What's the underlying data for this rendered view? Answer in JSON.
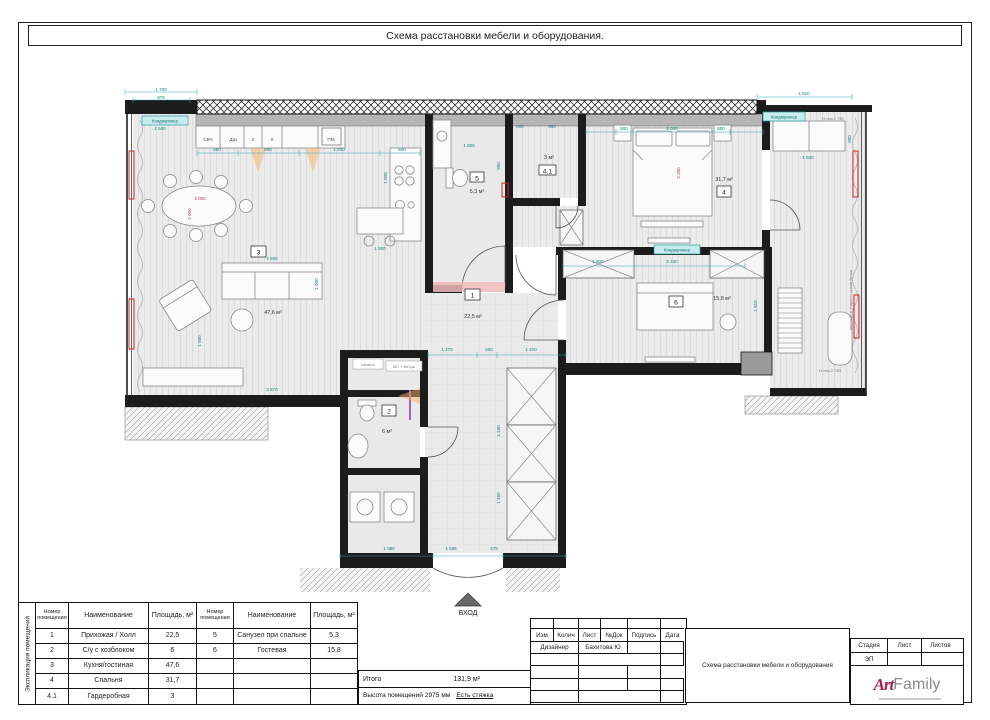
{
  "sheet": {
    "title": "Схема расстановки мебели и оборудования.",
    "side_label": "Экспликация помещений"
  },
  "plan": {
    "entrance_label": "ВХОД",
    "ac_label": "Кондиционер",
    "rooms": {
      "r1": {
        "num": "1",
        "area": "22,5 м²"
      },
      "r2": {
        "num": "2",
        "area": "6 м²"
      },
      "r3": {
        "num": "3",
        "area": "47,6 м²"
      },
      "r4": {
        "num": "4",
        "area": "31,7 м²"
      },
      "r41": {
        "num": "4.1",
        "area": "3 м²"
      },
      "r5": {
        "num": "5",
        "area": "5,3 м²"
      },
      "r6": {
        "num": "6",
        "area": "15,8 м²"
      }
    },
    "appliances": {
      "svch": "СВЧ",
      "dsh": "ДШ",
      "x1": "Х",
      "x2": "Х",
      "pm": "ПМ",
      "ms": "МС + МСуш",
      "shtanga": "Штанга"
    },
    "notes": {
      "laundry": "место для стирки и сушки белья",
      "h1": "H низ 2 730",
      "h2": "H низ 2 730"
    },
    "dims": {
      "d1": "1 700",
      "d2": "970",
      "d3": "600",
      "d4": "900",
      "d5": "1 200",
      "d6": "600",
      "d7": "500",
      "d8": "2 000",
      "d9": "500",
      "d10": "1 820",
      "d11": "1 600",
      "d12": "800",
      "d13": "2 300",
      "d14": "2 600",
      "d15": "1 000",
      "d16": "2 000",
      "d17": "1 000",
      "d18": "1 500",
      "d19": "1 500",
      "d20": "2 870",
      "d21": "1 500",
      "d22": "1 500",
      "d23": "1 600",
      "d24": "900",
      "d25": "600",
      "d26": "980",
      "d27": "1 800",
      "d28": "2 100",
      "d29": "1 810",
      "d30": "1 470",
      "d31": "600",
      "d32": "1 400",
      "d33": "1 160",
      "d34": "1 450",
      "d35": "1 085",
      "d36": "1 595",
      "d37": "475"
    }
  },
  "explication": {
    "headers": {
      "num": "Номер помещения",
      "name": "Наименование",
      "area": "Площадь, м²"
    },
    "left_rows": [
      [
        "1",
        "Прихожая / Холл",
        "22,5"
      ],
      [
        "2",
        "С/у с хозблоком",
        "6"
      ],
      [
        "3",
        "Кухня/гостиная",
        "47,6"
      ],
      [
        "4",
        "Спальня",
        "31,7"
      ],
      [
        "4.1",
        "Гардеробная",
        "3"
      ]
    ],
    "right_rows": [
      [
        "5",
        "Санузел при спальне",
        "5,3"
      ],
      [
        "6",
        "Гостевая",
        "15,8"
      ]
    ],
    "total_label": "Итого",
    "total_value": "131,9 м²",
    "height_note": "Высота помещений 2975 мм",
    "screed_note": "Есть стяжка"
  },
  "titleblock": {
    "cols": [
      "Изм",
      "Колич",
      "Лист",
      "№Док",
      "Подпись",
      "Дата"
    ],
    "designer_label": "Дизайнер",
    "designer_name": "Бахитова Ю",
    "doc_title": "Схема расстановки мебели и оборудования",
    "stage_label": "Стадия",
    "sheet_label": "Лист",
    "sheets_label": "Листов",
    "stage_value": "ЭП",
    "logo": {
      "art": "Art",
      "family": "Family"
    }
  }
}
